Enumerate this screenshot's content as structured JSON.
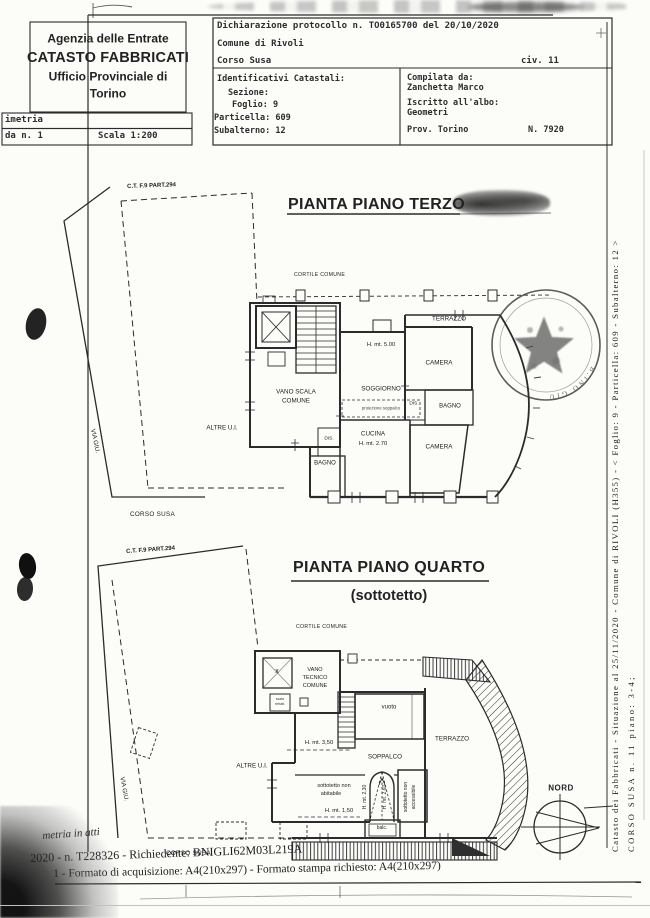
{
  "colors": {
    "ink": "#2b2b2b",
    "paper": "#fcfcf9"
  },
  "header": {
    "agency": {
      "line1": "Agenzia delle Entrate",
      "line2": "CATASTO FABBRICATI",
      "line3": "Ufficio Provinciale di",
      "line4": "Torino"
    },
    "planimetria_row": "imetria",
    "scheda_row": "da n. 1",
    "scala": "Scala 1:200",
    "protocol": "Dichiarazione protocollo n. TO0165700 del  20/10/2020",
    "comune": "Comune di Rivoli",
    "indirizzo": "Corso Susa",
    "civico": "civ. 11",
    "identificativi": {
      "title": "Identificativi Catastali:",
      "sezione": "Sezione:",
      "foglio": "Foglio: 9",
      "particella": "Particella: 609",
      "subalterno": "Subalterno: 12"
    },
    "compilatore": {
      "label": "Compilata da:",
      "nome": "Zanchetta Marco",
      "albo_label": "Iscritto all'albo:",
      "albo": "Geometri",
      "provincia": "Prov. Torino",
      "numero": "N. 7920"
    }
  },
  "labels": {
    "cortile_comune": "CORTILE COMUNE",
    "parcel_ref": "C.T. F.9 PART.294",
    "altre_ui": "ALTRE U.I.",
    "via": "VIA GIU.",
    "corso_susa": "CORSO SUSA",
    "terrazzo": "TERRAZZO",
    "camera": "CAMERA",
    "bagno": "BAGNO",
    "dis": "DIS.",
    "nord": "NORD"
  },
  "plan_terzo": {
    "title": "PIANTA PIANO TERZO",
    "vano_scala_1": "VANO SCALA",
    "vano_scala_2": "COMUNE",
    "soggiorno": "SOGGIORNO",
    "proiezione_soppalco": "proiezione soppalco",
    "h_500": "H. mt. 5.00",
    "cucina": "CUCINA",
    "h_270": "H. mt. 2.70"
  },
  "plan_quarto": {
    "title": "PIANTA PIANO QUARTO",
    "subtitle": "(sottotetto)",
    "vano_tecnico_1": "VANO",
    "vano_tecnico_2": "TECNICO",
    "vano_tecnico_3": "COMUNE",
    "x_mark": "x",
    "scala_retratt_1": "scala",
    "scala_retratt_2": "retratt.",
    "vuoto": "vuoto",
    "h_350": "H. mt. 3,50",
    "soppalco": "SOPPALCO",
    "sottotetto_na_1": "sottotetto non",
    "sottotetto_na_2": "abitabile",
    "h_150": "H. mt. 1,50",
    "h_230": "H. mt. 2,30",
    "h_260": "H. mt. 2,60",
    "sottotetto_acc_1": "sottotetto non",
    "sottotetto_acc_2": "accessibile",
    "balc": "balc."
  },
  "stamp_fragment": "B.INO GIU",
  "margin_text": {
    "line1": "Catasto dei Fabbricati - Situazione al 25/11/2020 - Comune di RIVOLI (H355) - <  Foglio: 9 - Particella: 609 - Subalterno: 12 >",
    "line2": "CORSO SUSA n. 11 piano: 3-4;"
  },
  "footer": {
    "line1": "metria in atti",
    "line2": "2020 - n. T228326 - Richiedente: BNIGLI62M03L219A",
    "line3": "1 - Formato di acquisizione: A4(210x297)  - Formato stampa richiesto: A4(210x297)"
  }
}
